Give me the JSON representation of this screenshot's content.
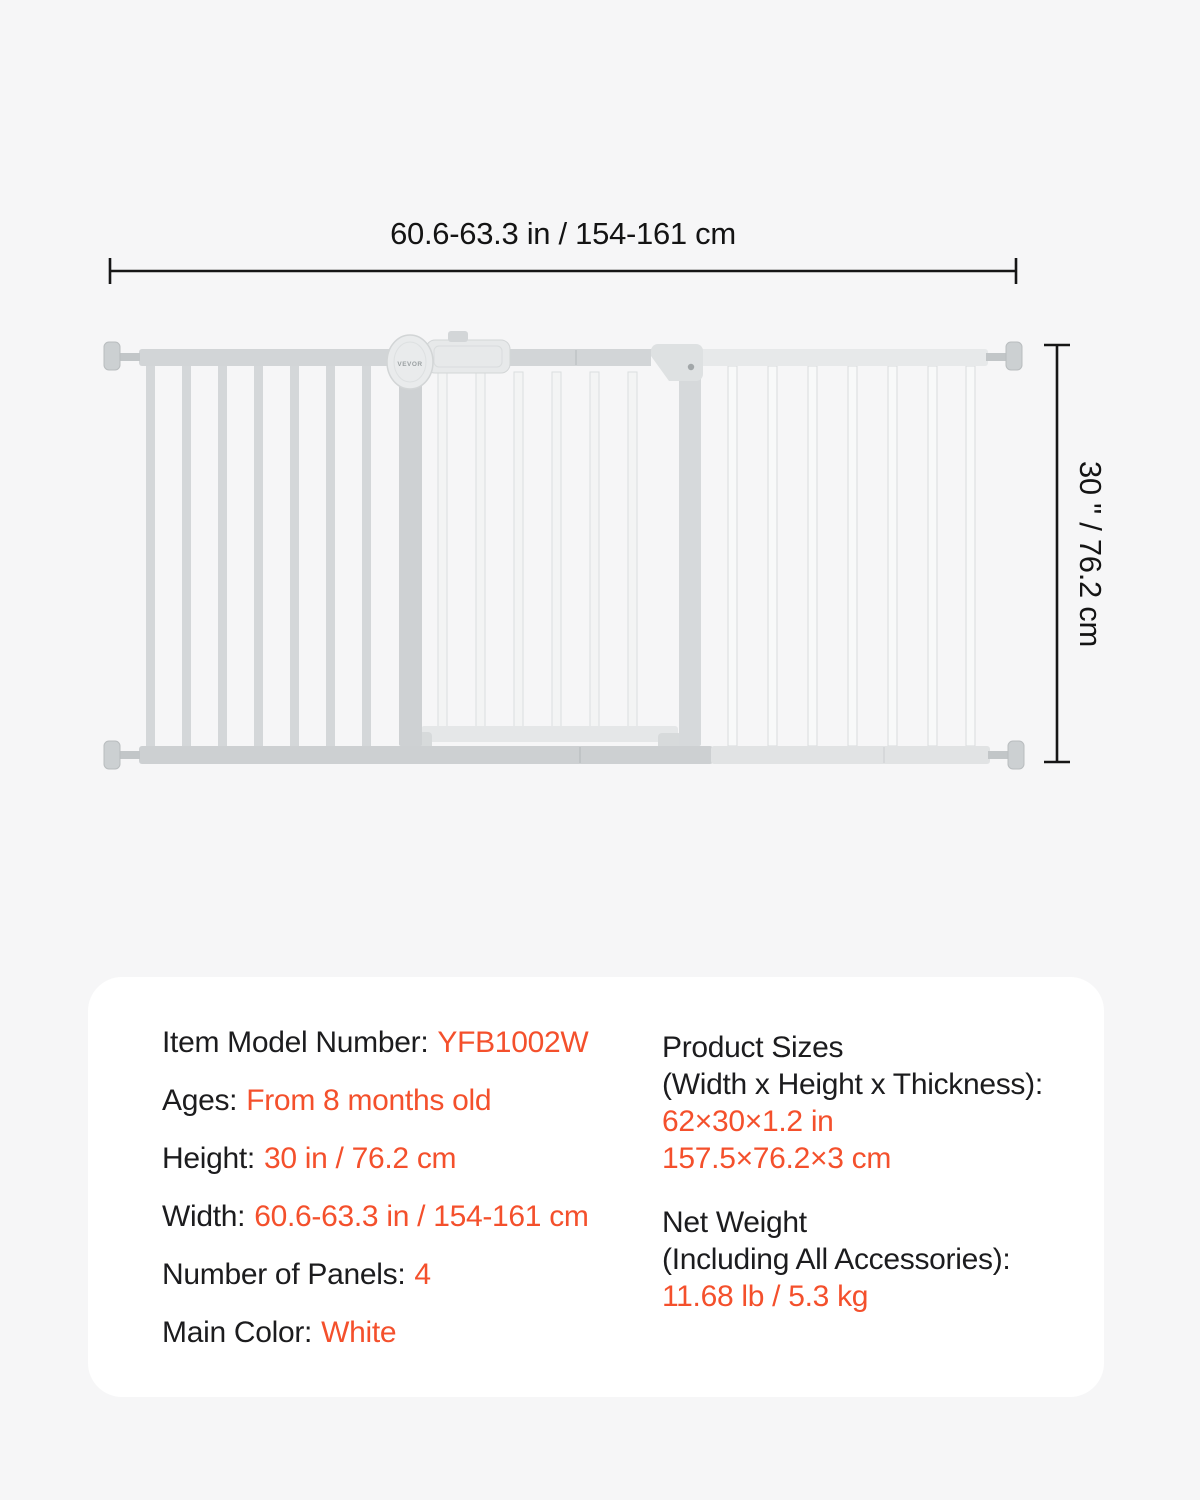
{
  "page": {
    "background_color": "#f6f6f7",
    "panel_color": "#ffffff",
    "accent_color": "#f4502c",
    "text_color": "#1c1c1e"
  },
  "diagram": {
    "width_dim_label": "60.6-63.3 in / 154-161 cm",
    "height_dim_label": "30 \" / 76.2 cm",
    "brand_logo": "VEVOR"
  },
  "specs": {
    "left": [
      {
        "label": "Item Model Number:",
        "value": "YFB1002W"
      },
      {
        "label": "Ages:",
        "value": "From 8 months old"
      },
      {
        "label": "Height:",
        "value": "30 in / 76.2 cm"
      },
      {
        "label": "Width:",
        "value": "60.6-63.3 in / 154-161 cm"
      },
      {
        "label": "Number of Panels:",
        "value": "4"
      },
      {
        "label": "Main Color:",
        "value": "White"
      }
    ],
    "right": [
      {
        "heading_lines": [
          "Product Sizes",
          "(Width x Height x Thickness):"
        ],
        "value_lines": [
          "62×30×1.2 in",
          "157.5×76.2×3 cm"
        ]
      },
      {
        "heading_lines": [
          "Net Weight",
          "(Including All Accessories):"
        ],
        "value_lines": [
          "11.68 lb / 5.3 kg"
        ]
      }
    ]
  }
}
